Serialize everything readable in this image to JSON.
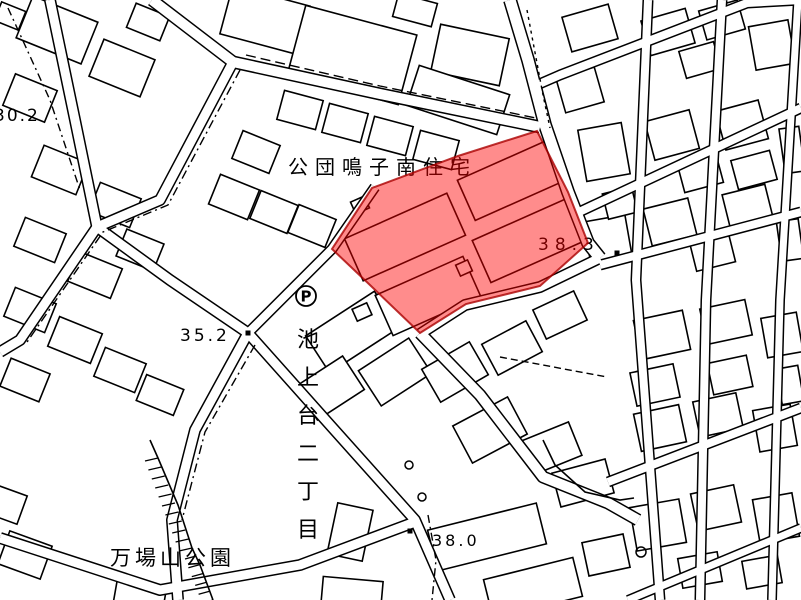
{
  "map": {
    "background_color": "#ffffff",
    "line_color": "#000000",
    "highlight": {
      "fill_color": "#ff0000",
      "fill_opacity": 0.45,
      "border_color": "#aa0000",
      "polygon": [
        [
          537,
          131
        ],
        [
          568,
          192
        ],
        [
          588,
          243
        ],
        [
          540,
          286
        ],
        [
          466,
          304
        ],
        [
          420,
          333
        ],
        [
          371,
          286
        ],
        [
          332,
          249
        ],
        [
          372,
          188
        ],
        [
          458,
          156
        ]
      ]
    },
    "labels": [
      {
        "id": "housing-complex-name",
        "text": "公団鳴子南住宅",
        "x": 288,
        "y": 174,
        "fs": 20,
        "ls": 7,
        "vertical": false
      },
      {
        "id": "district-name",
        "text": "池上台二丁目",
        "x": 297,
        "y": 325,
        "fs": 22,
        "ls": 16,
        "vertical": true
      },
      {
        "id": "park-name",
        "text": "万場山公園",
        "x": 110,
        "y": 565,
        "fs": 21,
        "ls": 4,
        "vertical": false
      },
      {
        "id": "spot-elevation-30-2",
        "text": "30.2",
        "x": -6,
        "y": 121,
        "fs": 17,
        "ls": 2,
        "vertical": false
      },
      {
        "id": "spot-elevation-35-2",
        "text": "35.2",
        "x": 180,
        "y": 341,
        "fs": 17,
        "ls": 3,
        "vertical": false
      },
      {
        "id": "spot-elevation-38-3",
        "text": "38.3",
        "x": 538,
        "y": 250,
        "fs": 17,
        "ls": 6,
        "vertical": false
      },
      {
        "id": "spot-elevation-38-0",
        "text": "38.0",
        "x": 432,
        "y": 546,
        "fs": 16,
        "ls": 3,
        "vertical": false
      }
    ],
    "parking": {
      "x": 306,
      "y": 296,
      "r": 10,
      "label": "P"
    },
    "roads": [
      {
        "id": "road-nw-top",
        "points": [
          [
            152,
            0
          ],
          [
            233,
            62
          ]
        ],
        "w": 10
      },
      {
        "id": "road-west-diagonal",
        "points": [
          [
            233,
            62
          ],
          [
            160,
            200
          ],
          [
            97,
            227
          ],
          [
            20,
            340
          ],
          [
            0,
            352
          ]
        ],
        "w": 9
      },
      {
        "id": "road-north-of-complex",
        "points": [
          [
            233,
            62
          ],
          [
            380,
            94
          ],
          [
            540,
            127
          ]
        ],
        "w": 10
      },
      {
        "id": "road-main-ns",
        "points": [
          [
            510,
            0
          ],
          [
            528,
            60
          ],
          [
            545,
            125
          ],
          [
            568,
            192
          ],
          [
            588,
            243
          ],
          [
            600,
            258
          ]
        ],
        "w": 11
      },
      {
        "id": "road-from-30-2",
        "points": [
          [
            50,
            0
          ],
          [
            75,
            120
          ],
          [
            97,
            227
          ],
          [
            170,
            280
          ],
          [
            248,
            333
          ]
        ],
        "w": 9
      },
      {
        "id": "road-to-38-0",
        "points": [
          [
            248,
            333
          ],
          [
            330,
            425
          ],
          [
            415,
            520
          ],
          [
            450,
            600
          ]
        ],
        "w": 9
      },
      {
        "id": "road-park-west",
        "points": [
          [
            248,
            333
          ],
          [
            195,
            430
          ],
          [
            172,
            520
          ],
          [
            178,
            600
          ]
        ],
        "w": 9
      },
      {
        "id": "road-se-from-tip",
        "points": [
          [
            420,
            333
          ],
          [
            480,
            395
          ],
          [
            543,
            477
          ],
          [
            608,
            503
          ],
          [
            638,
            520
          ]
        ],
        "w": 10
      },
      {
        "id": "road-complex-south",
        "points": [
          [
            600,
            258
          ],
          [
            540,
            287
          ],
          [
            465,
            305
          ],
          [
            420,
            334
          ]
        ],
        "w": 9
      },
      {
        "id": "road-complex-west",
        "points": [
          [
            248,
            333
          ],
          [
            332,
            249
          ],
          [
            375,
            187
          ]
        ],
        "w": 8
      },
      {
        "id": "road-park-south",
        "points": [
          [
            0,
            538
          ],
          [
            160,
            590
          ],
          [
            300,
            565
          ],
          [
            415,
            522
          ]
        ],
        "w": 9
      },
      {
        "id": "road-east-v1",
        "points": [
          [
            648,
            0
          ],
          [
            636,
            280
          ],
          [
            660,
            600
          ]
        ],
        "w": 8
      },
      {
        "id": "road-east-v2",
        "points": [
          [
            722,
            0
          ],
          [
            706,
            300
          ],
          [
            700,
            600
          ]
        ],
        "w": 8
      },
      {
        "id": "road-east-v3",
        "points": [
          [
            798,
            0
          ],
          [
            780,
            300
          ],
          [
            772,
            600
          ]
        ],
        "w": 7
      },
      {
        "id": "road-ne-1",
        "points": [
          [
            537,
            85
          ],
          [
            560,
            75
          ],
          [
            747,
            3
          ],
          [
            801,
            0
          ]
        ],
        "w": 8
      },
      {
        "id": "road-ne-2",
        "points": [
          [
            577,
            213
          ],
          [
            801,
            108
          ]
        ],
        "w": 8
      },
      {
        "id": "road-ne-3",
        "points": [
          [
            600,
            265
          ],
          [
            801,
            212
          ]
        ],
        "w": 8
      },
      {
        "id": "road-ne-4",
        "points": [
          [
            608,
            482
          ],
          [
            801,
            408
          ]
        ],
        "w": 8
      },
      {
        "id": "road-ne-5",
        "points": [
          [
            628,
            600
          ],
          [
            801,
            528
          ]
        ],
        "w": 7
      }
    ],
    "dashed_lines": [
      {
        "points": [
          [
            8,
            8
          ],
          [
            50,
            100
          ],
          [
            80,
            190
          ]
        ],
        "dash": "8 4 2 4"
      },
      {
        "points": [
          [
            246,
            55
          ],
          [
            380,
            86
          ],
          [
            536,
            118
          ]
        ],
        "dash": "10 5"
      },
      {
        "points": [
          [
            240,
            70
          ],
          [
            168,
            205
          ],
          [
            103,
            232
          ],
          [
            25,
            345
          ]
        ],
        "dash": "9 4 2 4"
      },
      {
        "points": [
          [
            428,
            515
          ],
          [
            436,
            560
          ],
          [
            432,
            600
          ]
        ],
        "dash": "8 4 2 4"
      },
      {
        "points": [
          [
            255,
            345
          ],
          [
            205,
            432
          ],
          [
            182,
            520
          ]
        ],
        "dash": "9 4 2 4"
      },
      {
        "points": [
          [
            500,
            357
          ],
          [
            607,
            377
          ]
        ],
        "dash": "7 4"
      },
      {
        "points": [
          [
            527,
            10
          ],
          [
            543,
            95
          ],
          [
            550,
            128
          ]
        ],
        "dash": "3 4"
      }
    ],
    "extra_lines": [
      {
        "points": [
          [
            150,
            440
          ],
          [
            158,
            458
          ],
          [
            178,
            505
          ],
          [
            192,
            548
          ],
          [
            200,
            565
          ],
          [
            213,
            600
          ]
        ]
      },
      {
        "points": [
          [
            543,
            440
          ],
          [
            555,
            465
          ],
          [
            585,
            492
          ],
          [
            620,
            500
          ],
          [
            634,
            498
          ]
        ]
      }
    ],
    "hatches": [
      {
        "p1": [
          158,
          458
        ],
        "p2": [
          192,
          548
        ],
        "n": 11,
        "dx": -13,
        "dy": 3
      },
      {
        "p1": [
          196,
          556
        ],
        "p2": [
          213,
          600
        ],
        "n": 6,
        "dx": -11,
        "dy": 3
      }
    ],
    "buildings": [
      [
        57,
        30,
        70,
        45,
        22
      ],
      [
        122,
        68,
        55,
        40,
        22
      ],
      [
        30,
        98,
        45,
        34,
        22
      ],
      [
        10,
        16,
        26,
        20,
        22
      ],
      [
        148,
        22,
        36,
        26,
        22
      ],
      [
        60,
        170,
        48,
        34,
        22
      ],
      [
        115,
        205,
        44,
        31,
        22
      ],
      [
        40,
        240,
        44,
        31,
        22
      ],
      [
        95,
        275,
        46,
        32,
        22
      ],
      [
        30,
        310,
        44,
        31,
        22
      ],
      [
        140,
        250,
        40,
        29,
        22
      ],
      [
        75,
        340,
        46,
        32,
        22
      ],
      [
        25,
        380,
        42,
        30,
        22
      ],
      [
        120,
        370,
        44,
        31,
        22
      ],
      [
        160,
        395,
        40,
        28,
        22
      ],
      [
        25,
        555,
        45,
        35,
        20
      ],
      [
        8,
        505,
        30,
        30,
        20
      ],
      [
        140,
        595,
        50,
        24,
        10
      ],
      [
        265,
        20,
        80,
        50,
        15
      ],
      [
        352,
        55,
        115,
        72,
        15
      ],
      [
        470,
        55,
        70,
        48,
        12
      ],
      [
        458,
        100,
        95,
        42,
        18
      ],
      [
        415,
        10,
        40,
        24,
        15
      ],
      [
        300,
        110,
        40,
        30,
        15
      ],
      [
        345,
        123,
        40,
        30,
        15
      ],
      [
        390,
        136,
        40,
        30,
        15
      ],
      [
        436,
        150,
        40,
        30,
        15
      ],
      [
        256,
        152,
        40,
        30,
        22
      ],
      [
        234,
        197,
        42,
        32,
        22
      ],
      [
        274,
        212,
        40,
        30,
        22
      ],
      [
        312,
        226,
        40,
        30,
        22
      ],
      [
        352,
        332,
        82,
        44,
        -33
      ],
      [
        330,
        388,
        56,
        40,
        -33
      ],
      [
        395,
        372,
        60,
        42,
        -33
      ],
      [
        455,
        372,
        55,
        38,
        -30
      ],
      [
        512,
        348,
        50,
        35,
        -28
      ],
      [
        560,
        315,
        45,
        32,
        -25
      ],
      [
        490,
        430,
        62,
        42,
        -28
      ],
      [
        552,
        448,
        50,
        36,
        -22
      ],
      [
        583,
        483,
        55,
        35,
        -15
      ],
      [
        606,
        555,
        42,
        34,
        -12
      ],
      [
        487,
        537,
        112,
        42,
        -14
      ],
      [
        533,
        588,
        92,
        40,
        -14
      ],
      [
        350,
        532,
        36,
        52,
        12
      ],
      [
        352,
        593,
        60,
        28,
        5
      ],
      [
        590,
        28,
        48,
        36,
        -16
      ],
      [
        668,
        32,
        46,
        36,
        -16
      ],
      [
        722,
        20,
        40,
        30,
        -16
      ],
      [
        772,
        45,
        40,
        44,
        -10
      ],
      [
        700,
        60,
        36,
        28,
        -16
      ],
      [
        580,
        90,
        40,
        36,
        -16
      ],
      [
        604,
        152,
        44,
        52,
        -10
      ],
      [
        672,
        135,
        46,
        40,
        -15
      ],
      [
        700,
        172,
        40,
        32,
        -15
      ],
      [
        742,
        125,
        44,
        40,
        -15
      ],
      [
        754,
        170,
        40,
        30,
        -15
      ],
      [
        792,
        150,
        20,
        45,
        -8
      ],
      [
        608,
        240,
        42,
        44,
        -10
      ],
      [
        620,
        203,
        30,
        26,
        -14
      ],
      [
        670,
        222,
        46,
        38,
        -14
      ],
      [
        712,
        250,
        40,
        34,
        -14
      ],
      [
        748,
        208,
        44,
        38,
        -14
      ],
      [
        790,
        240,
        22,
        40,
        -8
      ],
      [
        662,
        335,
        50,
        40,
        -12
      ],
      [
        726,
        322,
        46,
        36,
        -12
      ],
      [
        782,
        335,
        36,
        40,
        -10
      ],
      [
        655,
        385,
        44,
        34,
        -12
      ],
      [
        730,
        375,
        40,
        32,
        -12
      ],
      [
        790,
        385,
        22,
        36,
        -10
      ],
      [
        660,
        428,
        46,
        38,
        -12
      ],
      [
        718,
        415,
        44,
        36,
        -12
      ],
      [
        775,
        428,
        38,
        42,
        -10
      ],
      [
        658,
        525,
        50,
        44,
        -10
      ],
      [
        716,
        508,
        44,
        38,
        -12
      ],
      [
        776,
        518,
        40,
        44,
        -10
      ],
      [
        700,
        570,
        40,
        30,
        -10
      ],
      [
        762,
        572,
        36,
        28,
        -10
      ]
    ],
    "apartment_blocks": [
      [
        405,
        237,
        112,
        46,
        -24
      ],
      [
        512,
        180,
        100,
        44,
        -24
      ],
      [
        428,
        296,
        96,
        44,
        -24
      ],
      [
        530,
        240,
        106,
        46,
        -24
      ],
      [
        360,
        205,
        15,
        13,
        -24
      ],
      [
        362,
        312,
        16,
        13,
        -24
      ],
      [
        464,
        268,
        13,
        12,
        -24
      ]
    ],
    "circles": [
      [
        409,
        465,
        4
      ],
      [
        422,
        497,
        4
      ],
      [
        641,
        552,
        5
      ]
    ],
    "dots": [
      [
        248,
        333
      ],
      [
        410,
        531
      ],
      [
        617,
        253
      ]
    ]
  }
}
